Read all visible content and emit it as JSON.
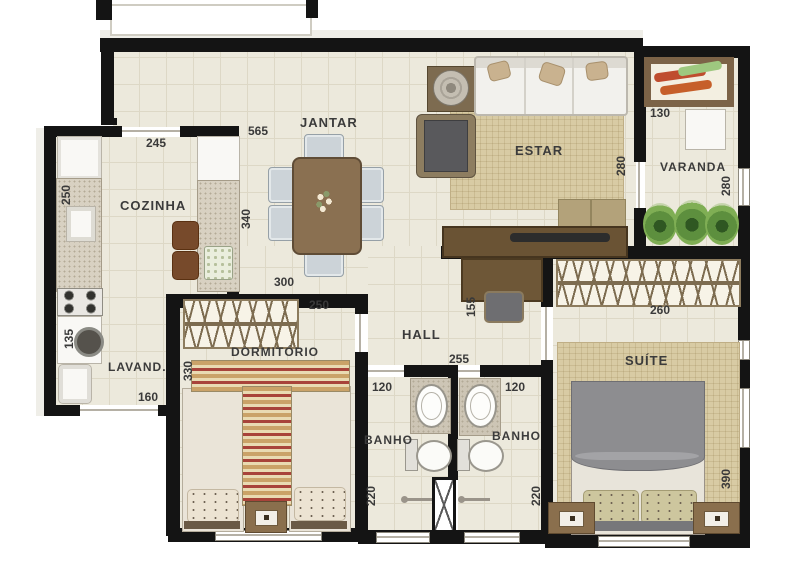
{
  "plan_title": "apartment-floor-plan",
  "colors": {
    "wall": "#141414",
    "floor": "#ece9dc",
    "floor_grid": "#ddd8c6",
    "rug": "#d8cba4",
    "wood_dark": "#6a5334",
    "wood": "#8a7051",
    "upholstery": "#ccd3d8",
    "plant_green": "#5d8f3e",
    "stripe_red": "#a8433a",
    "stripe_tan": "#c79e63"
  },
  "rooms": {
    "cozinha": {
      "label": "COZINHA",
      "width": "245",
      "depth": "250"
    },
    "jantar": {
      "label": "JANTAR",
      "width": "565",
      "depth": "340",
      "opening": "300"
    },
    "estar": {
      "label": "ESTAR",
      "depth": "280"
    },
    "varanda": {
      "label": "VARANDA",
      "width": "130",
      "depth": "280"
    },
    "lavanderia": {
      "label": "LAVAND.",
      "width": "160",
      "depth": "135"
    },
    "dormitorio": {
      "label": "DORMITÓRIO",
      "width": "250",
      "depth": "330"
    },
    "hall": {
      "label": "HALL",
      "width": "255",
      "nook": "155"
    },
    "banho1": {
      "label": "BANHO",
      "width": "120",
      "depth": "220"
    },
    "banho2": {
      "label": "BANHO",
      "width": "120",
      "depth": "220"
    },
    "suite": {
      "label": "SUÍTE",
      "width": "260",
      "depth": "390"
    }
  }
}
